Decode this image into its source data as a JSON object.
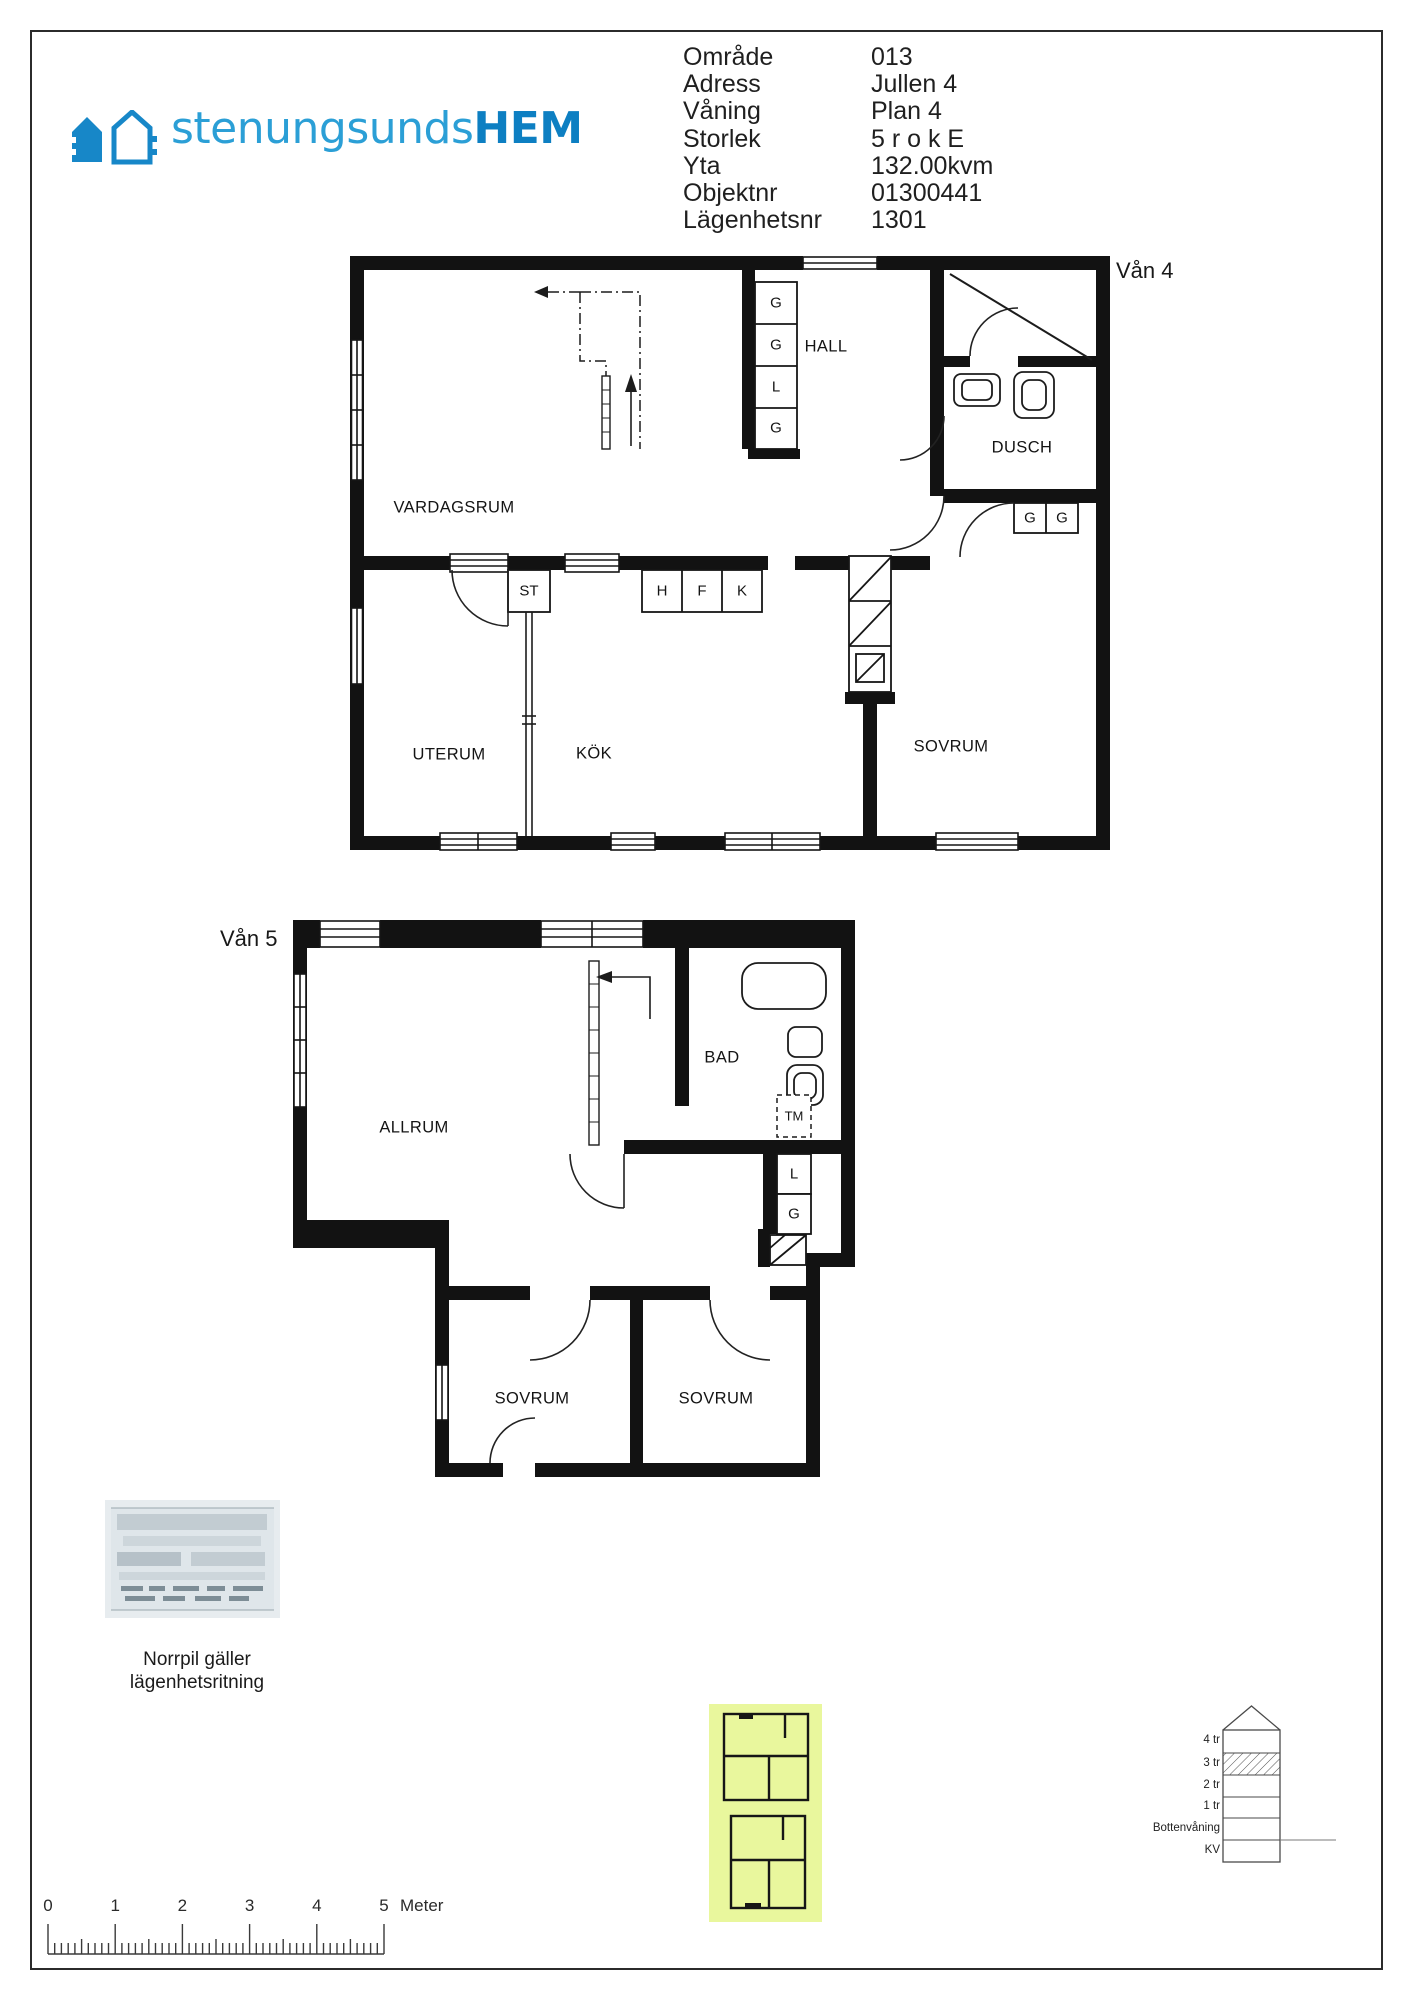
{
  "colors": {
    "logo_blue": "#2b9fd6",
    "logo_blue_dark": "#0d7fc2",
    "highlight_yellow": "#e9f79d"
  },
  "logo": {
    "brand_light": "stenungsunds",
    "brand_bold": "HEM"
  },
  "property_info": {
    "rows": [
      {
        "label": "Område",
        "value": "013"
      },
      {
        "label": "Adress",
        "value": "Jullen 4"
      },
      {
        "label": "Våning",
        "value": "Plan 4"
      },
      {
        "label": "Storlek",
        "value": "5 r o k E"
      },
      {
        "label": "Yta",
        "value": "132.00kvm"
      },
      {
        "label": "Objektnr",
        "value": "01300441"
      },
      {
        "label": "Lägenhetsnr",
        "value": "1301"
      }
    ]
  },
  "plan4": {
    "title": "Vån 4",
    "rooms": {
      "vardagsrum": "VARDAGSRUM",
      "hall": "HALL",
      "dusch": "DUSCH",
      "uterum": "UTERUM",
      "kok": "KÖK",
      "sovrum": "SOVRUM"
    },
    "hall_closets": [
      "G",
      "G",
      "L",
      "G"
    ],
    "storage": "ST",
    "kitchen_units": [
      "H",
      "F",
      "K"
    ],
    "bedroom_closets": [
      "G",
      "G"
    ]
  },
  "plan5": {
    "title": "Vån 5",
    "rooms": {
      "allrum": "ALLRUM",
      "bad": "BAD",
      "sovrum_left": "SOVRUM",
      "sovrum_right": "SOVRUM"
    },
    "washer": "TM",
    "closets": [
      "L",
      "G"
    ]
  },
  "north_note": {
    "line1": "Norrpil gäller",
    "line2": "lägenhetsritning"
  },
  "section_diagram": {
    "levels": [
      "4 tr",
      "3 tr",
      "2 tr",
      "1 tr",
      "Bottenvåning",
      "KV"
    ],
    "highlighted_level": "3 tr"
  },
  "scale_bar": {
    "labels": [
      "0",
      "1",
      "2",
      "3",
      "4",
      "5"
    ],
    "unit": "Meter",
    "meter_px": 67.2,
    "minor_per_major": 10
  }
}
